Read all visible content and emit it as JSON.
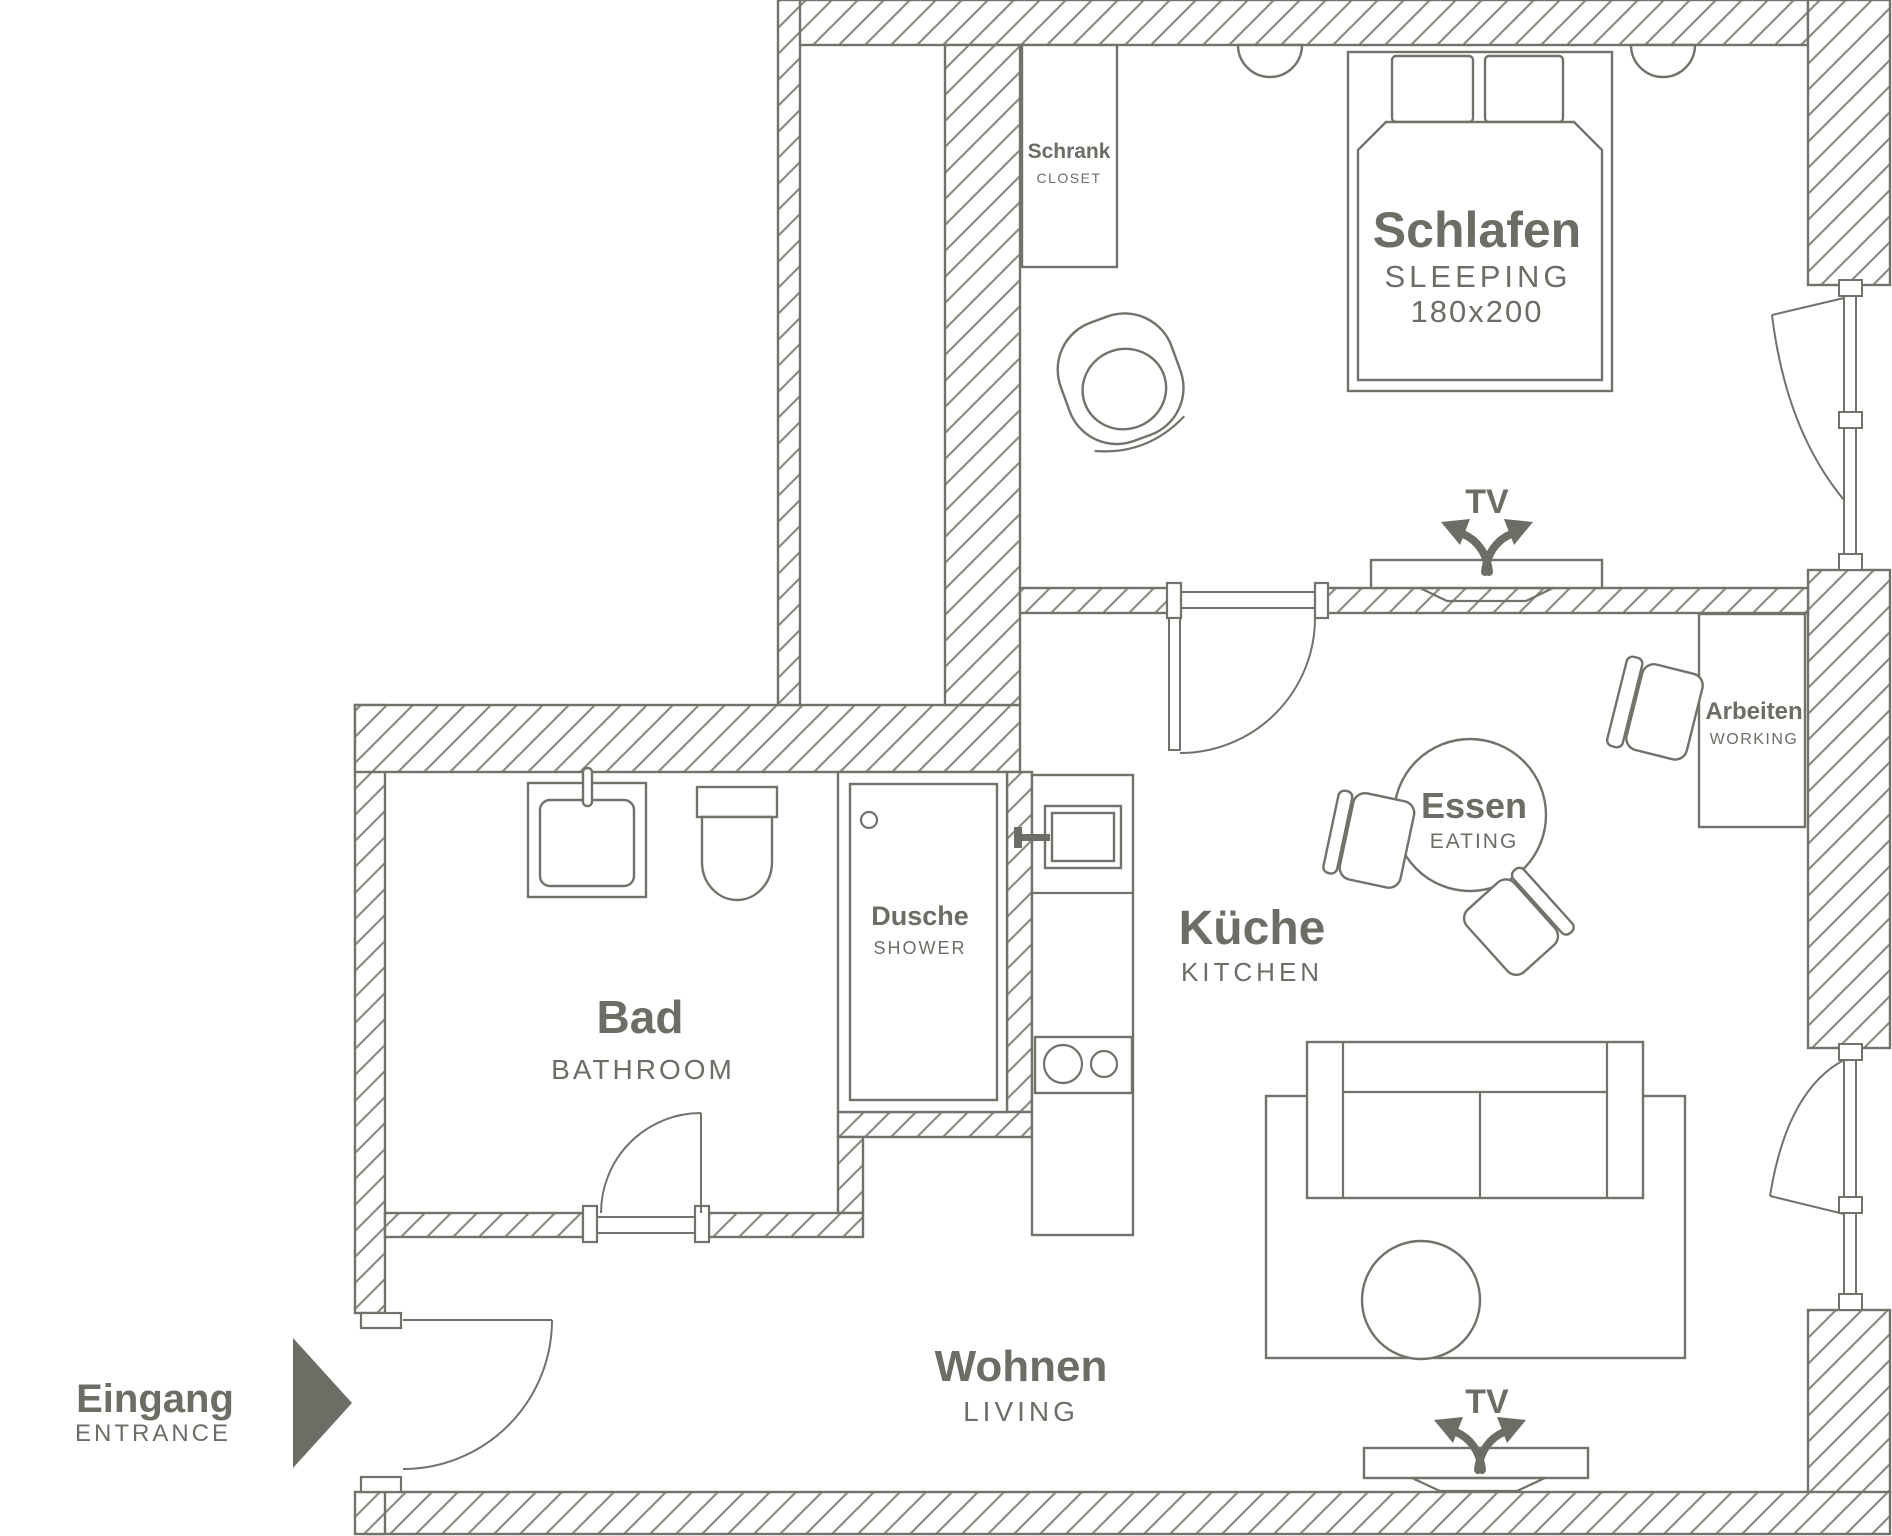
{
  "rooms": {
    "sleeping": {
      "de": "Schlafen",
      "en": "SLEEPING",
      "size": "180x200"
    },
    "closet": {
      "de": "Schrank",
      "en": "CLOSET"
    },
    "working": {
      "de": "Arbeiten",
      "en": "WORKING"
    },
    "eating": {
      "de": "Essen",
      "en": "EATING"
    },
    "kitchen": {
      "de": "Küche",
      "en": "KITCHEN"
    },
    "shower": {
      "de": "Dusche",
      "en": "SHOWER"
    },
    "bathroom": {
      "de": "Bad",
      "en": "BATHROOM"
    },
    "living": {
      "de": "Wohnen",
      "en": "LIVING"
    },
    "entrance": {
      "de": "Eingang",
      "en": "ENTRANCE"
    }
  },
  "labels": {
    "tv_bedroom": "TV",
    "tv_living": "TV"
  },
  "colors": {
    "line": "#72726a",
    "text": "#6d6d66",
    "hatch": "#8c8c84",
    "background": "#ffffff"
  }
}
